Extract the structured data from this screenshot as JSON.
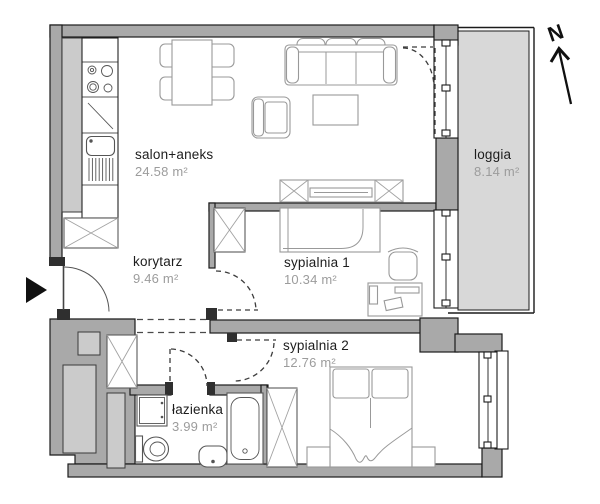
{
  "plan_title": "apartment floor plan",
  "rooms": [
    {
      "id": "salon",
      "name": "salon+aneks",
      "area": "24.58 m²"
    },
    {
      "id": "korytarz",
      "name": "korytarz",
      "area": "9.46 m²"
    },
    {
      "id": "sypialnia1",
      "name": "sypialnia 1",
      "area": "10.34 m²"
    },
    {
      "id": "sypialnia2",
      "name": "sypialnia 2",
      "area": "12.76 m²"
    },
    {
      "id": "lazienka",
      "name": "łazienka",
      "area": "3.99 m²"
    },
    {
      "id": "loggia",
      "name": "loggia",
      "area": "8.14 m²"
    }
  ],
  "compass": {
    "label": "N"
  },
  "icons": [
    "north-arrow-icon",
    "entrance-arrow-icon",
    "sofa",
    "armchair",
    "coffee-table",
    "dining-table",
    "chair",
    "kitchen-counter",
    "stove",
    "sink",
    "tv-cabinet",
    "wardrobe",
    "single-bed",
    "double-bed",
    "desk",
    "office-chair",
    "nightstand",
    "washing-machine",
    "toilet",
    "washbasin",
    "bathtub",
    "window",
    "door-swing"
  ],
  "colors": {
    "wall": "#a9a9a9",
    "loggia": "#d8d8d8",
    "shaft": "#cbcbcb",
    "outline": "#1b1b1b",
    "furniture": "#999999",
    "label": "#1d1d1d",
    "area": "#9c9c9c"
  }
}
